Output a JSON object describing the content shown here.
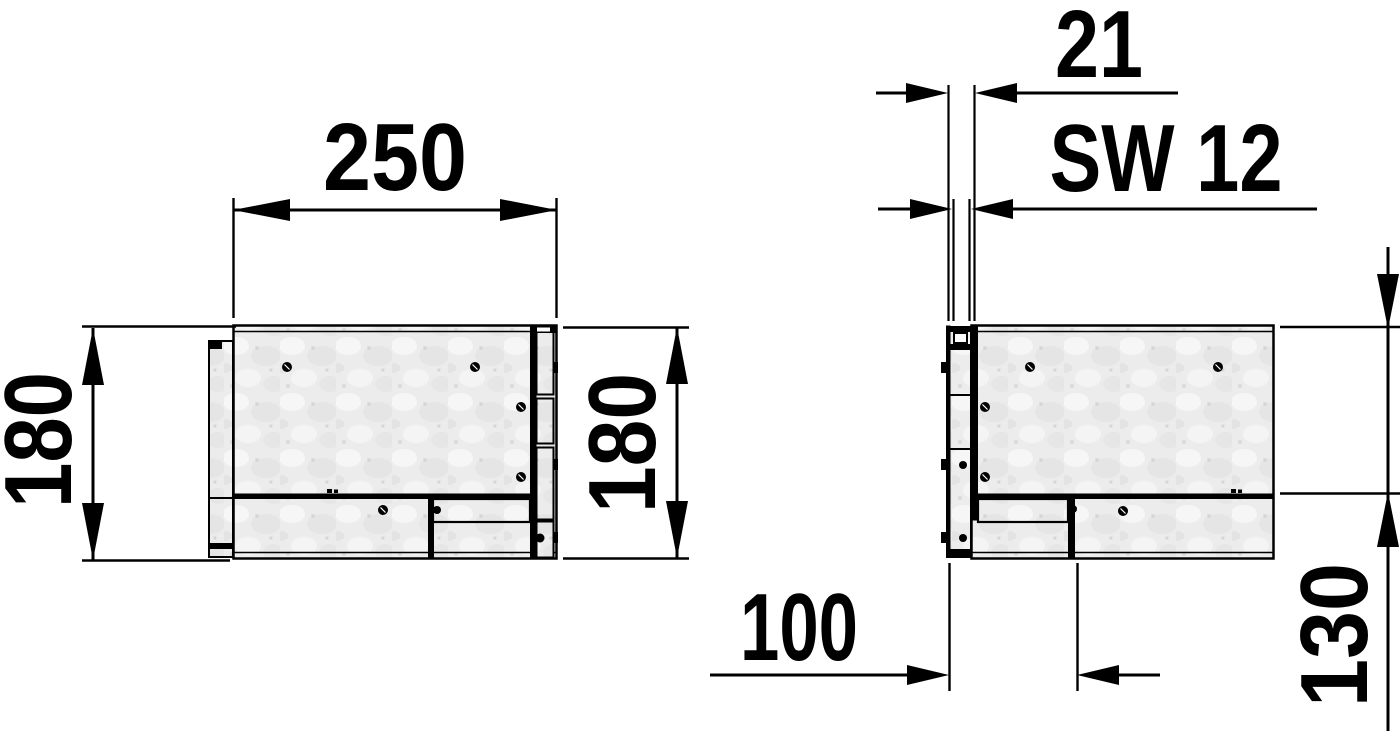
{
  "drawing": {
    "background": "#ffffff",
    "line_color": "#000000",
    "body_fill": "#ececec",
    "dimensions": {
      "width": "250",
      "height_left": "180",
      "height_right": "180",
      "plate_offset": "21",
      "wrench_size": "SW 12",
      "depth": "100",
      "front_height": "130"
    }
  }
}
